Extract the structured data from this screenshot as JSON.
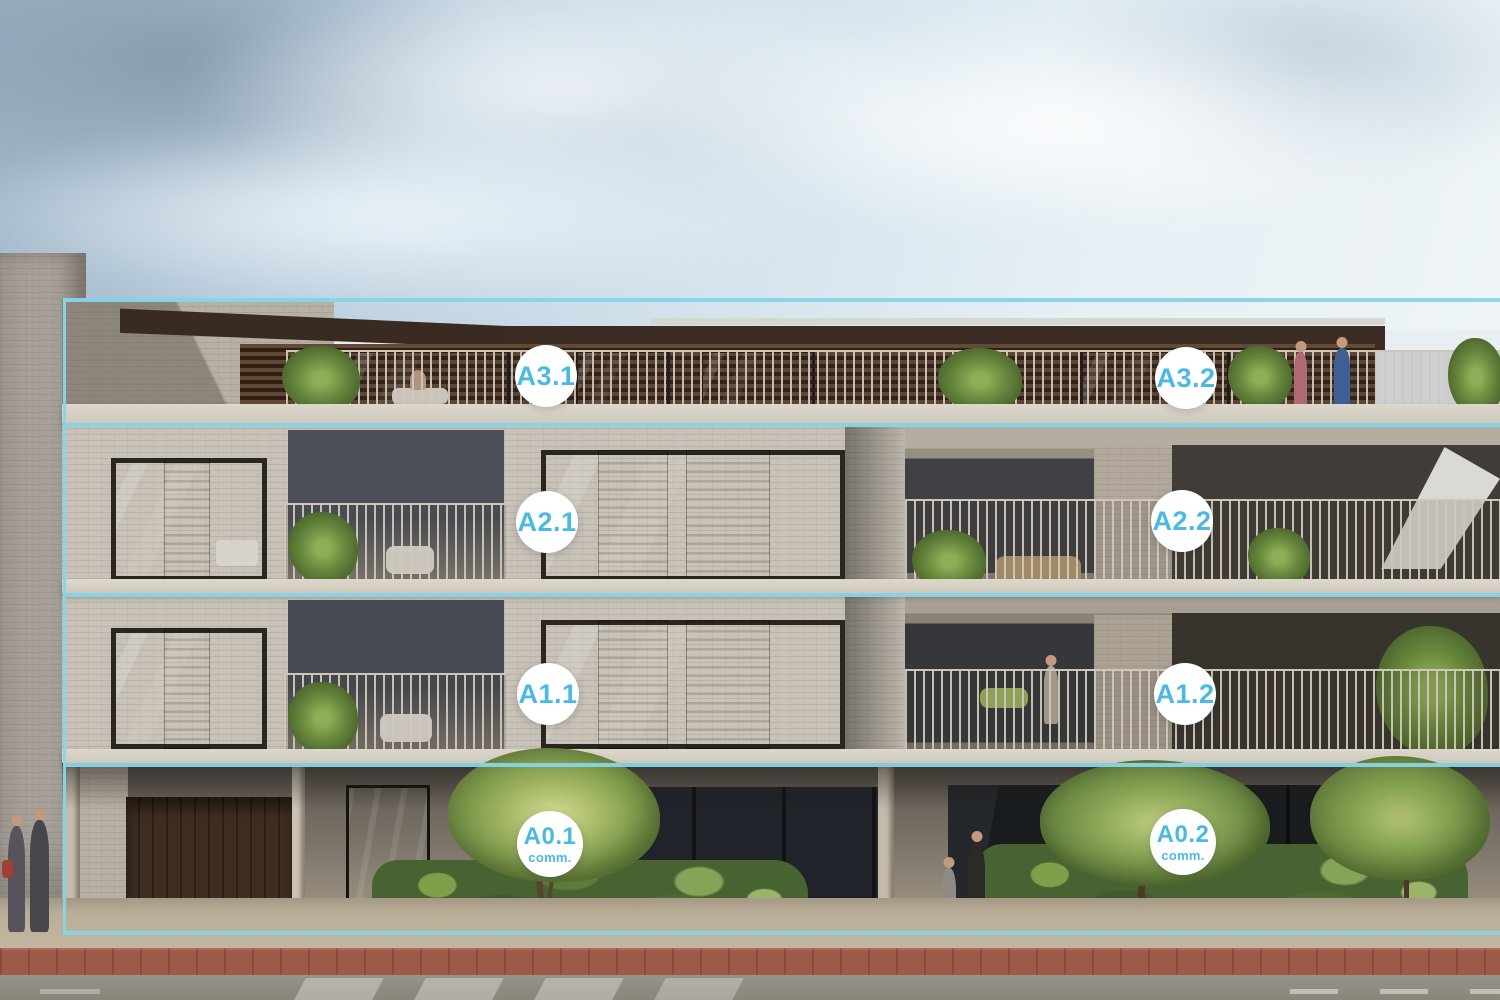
{
  "overlay": {
    "accent_color": "#86d5e8",
    "badge_bg_color": "#ffffff",
    "badge_text_color": "#4cb9e3",
    "left_edge_x": 63,
    "line_thickness": 4,
    "floor_bands": [
      {
        "floor": "3",
        "top": 298,
        "bottom": 423
      },
      {
        "floor": "2",
        "top": 423,
        "bottom": 593
      },
      {
        "floor": "1",
        "top": 593,
        "bottom": 763
      },
      {
        "floor": "0",
        "top": 763,
        "bottom": 931
      }
    ],
    "units": [
      {
        "id": "A3.1",
        "label": "A3.1",
        "sub": "",
        "cx": 546,
        "cy": 376,
        "d": 62
      },
      {
        "id": "A3.2",
        "label": "A3.2",
        "sub": "",
        "cx": 1186,
        "cy": 378,
        "d": 62
      },
      {
        "id": "A2.1",
        "label": "A2.1",
        "sub": "",
        "cx": 547,
        "cy": 522,
        "d": 62
      },
      {
        "id": "A2.2",
        "label": "A2.2",
        "sub": "",
        "cx": 1182,
        "cy": 521,
        "d": 62
      },
      {
        "id": "A1.1",
        "label": "A1.1",
        "sub": "",
        "cx": 548,
        "cy": 694,
        "d": 62
      },
      {
        "id": "A1.2",
        "label": "A1.2",
        "sub": "",
        "cx": 1185,
        "cy": 694,
        "d": 62
      },
      {
        "id": "A0.1",
        "label": "A0.1",
        "sub": "comm.",
        "cx": 550,
        "cy": 844,
        "d": 66
      },
      {
        "id": "A0.2",
        "label": "A0.2",
        "sub": "comm.",
        "cx": 1183,
        "cy": 842,
        "d": 66
      }
    ]
  }
}
